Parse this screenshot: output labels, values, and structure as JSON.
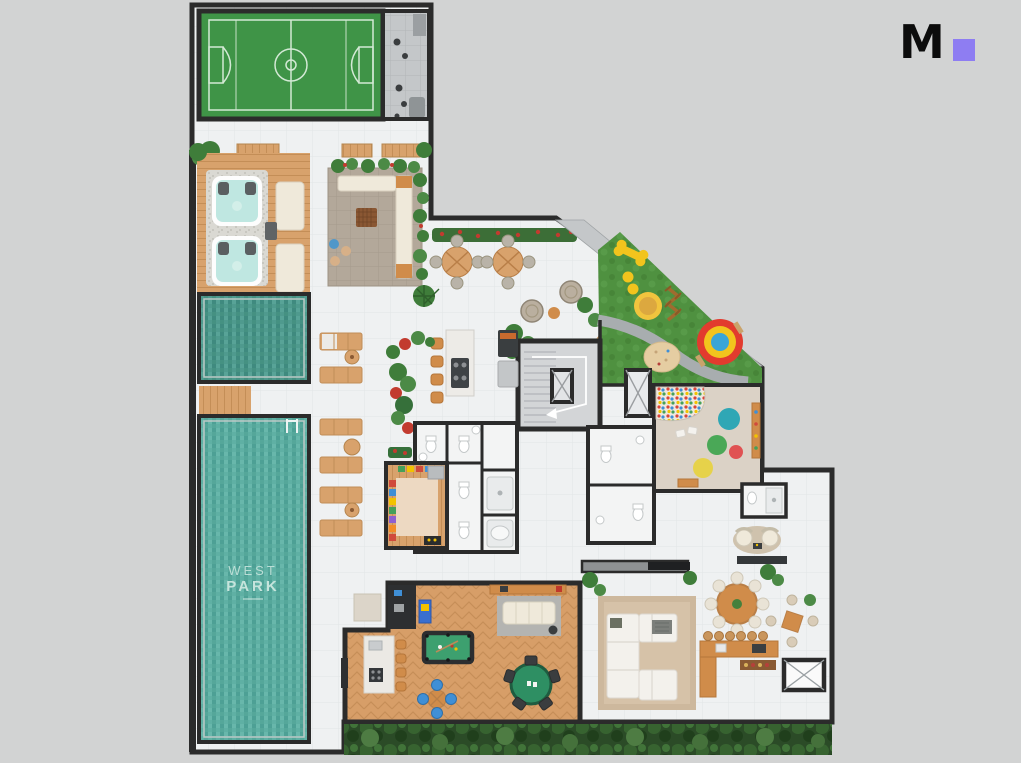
{
  "logo": {
    "letter": "M"
  },
  "floor_plan": {
    "pool_label": {
      "line1": "WEST",
      "line2": "PARK"
    }
  },
  "colors": {
    "page_bg": "#d2d3d3",
    "logo_accent": "#8e7df2",
    "wall": "#2b2b2b",
    "paving": "#eff1f2",
    "paving_line": "#e2e5e6",
    "gray_zone": "#c4c7c9",
    "court_green": "#3f9447",
    "court_line": "#d3e9d5",
    "pool_teal": "#5fb0a4",
    "pool_dark": "#4f9a8e",
    "pool_text": "#c6e4dc",
    "wood": "#d8a26c",
    "herring": "#d79e68",
    "grass": "#4f9140",
    "path_gray": "#a8adaf",
    "stone": "#b3a89a",
    "hedge": "#2b4b27",
    "plant": "#3f7d3a",
    "plant_light": "#4c8a46",
    "flower_red": "#c23b2f",
    "cream": "#efe9da",
    "counter_orange": "#d08c4a",
    "felt_green": "#3da06f",
    "table_green": "#2e8f63",
    "play_yellow": "#f2c41d",
    "play_red": "#e23b2e",
    "play_blue": "#3aa5d6",
    "sand": "#e5cda2",
    "rug_beige": "#cdb89d",
    "fixture_white": "#f3f4f4",
    "playroom_floor": "#dbd2c6",
    "dot_teal": "#2fa7b5",
    "dot_green": "#4aa857",
    "dot_red": "#e05252",
    "dot_yellow": "#e6d24a"
  }
}
